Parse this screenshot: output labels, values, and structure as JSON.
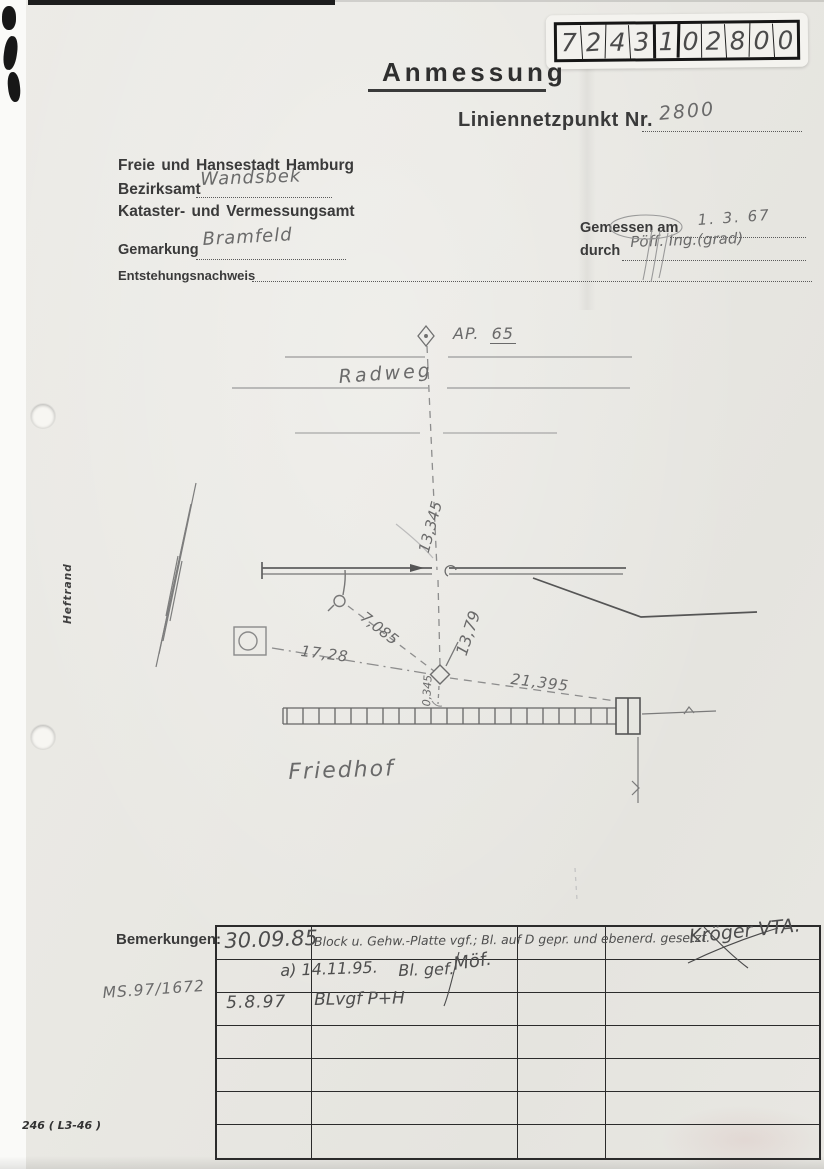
{
  "form_number": {
    "digits": [
      "7",
      "2",
      "4",
      "3",
      "1",
      "0",
      "2",
      "8",
      "0",
      "0"
    ]
  },
  "header": {
    "title": "Anmessung",
    "point_label": "Liniennetzpunkt Nr.",
    "point_value": "2800",
    "agency_line1": "Freie und Hansestadt Hamburg",
    "agency_line2_label": "Bezirksamt",
    "agency_line2_value": "Wandsbek",
    "agency_line3": "Kataster- und Vermessungsamt",
    "gemarkung_label": "Gemarkung",
    "gemarkung_value": "Bramfeld",
    "entstehung_label": "Entstehungsnachweis",
    "gemessen_label": "Gemessen am",
    "gemessen_value": "1. 3. 67",
    "durch_label": "durch",
    "durch_value": "Pöff.  Ing.(grad)"
  },
  "sketch": {
    "ap_label": "AP.",
    "ap_number": "65",
    "radweg": "Radweg",
    "friedhof": "Friedhof",
    "heftrand": "Heftrand",
    "measurements": {
      "m13345": "13,345",
      "m1379": "13,79",
      "m7085": "7,085",
      "m1728": "17,28",
      "m21395": "21,395",
      "m0345": "0,345"
    }
  },
  "remarks": {
    "label": "Bemerkungen:",
    "margin_note": "MS.97/1672",
    "rows": [
      {
        "date": "30.09.85",
        "text": "Block u. Gehw.-Platte vgf.; Bl. auf D gepr. und ebenerd. gesetzt.",
        "sig": "Kröger VTA."
      },
      {
        "date": "a) 14.11.95.",
        "text": "Bl. gef.",
        "sig": "Möf."
      },
      {
        "date": "5.8.97",
        "text": "BLvgf  P+H",
        "sig": ""
      }
    ]
  },
  "footer": {
    "form_code": "246 ( L3-46 )"
  }
}
